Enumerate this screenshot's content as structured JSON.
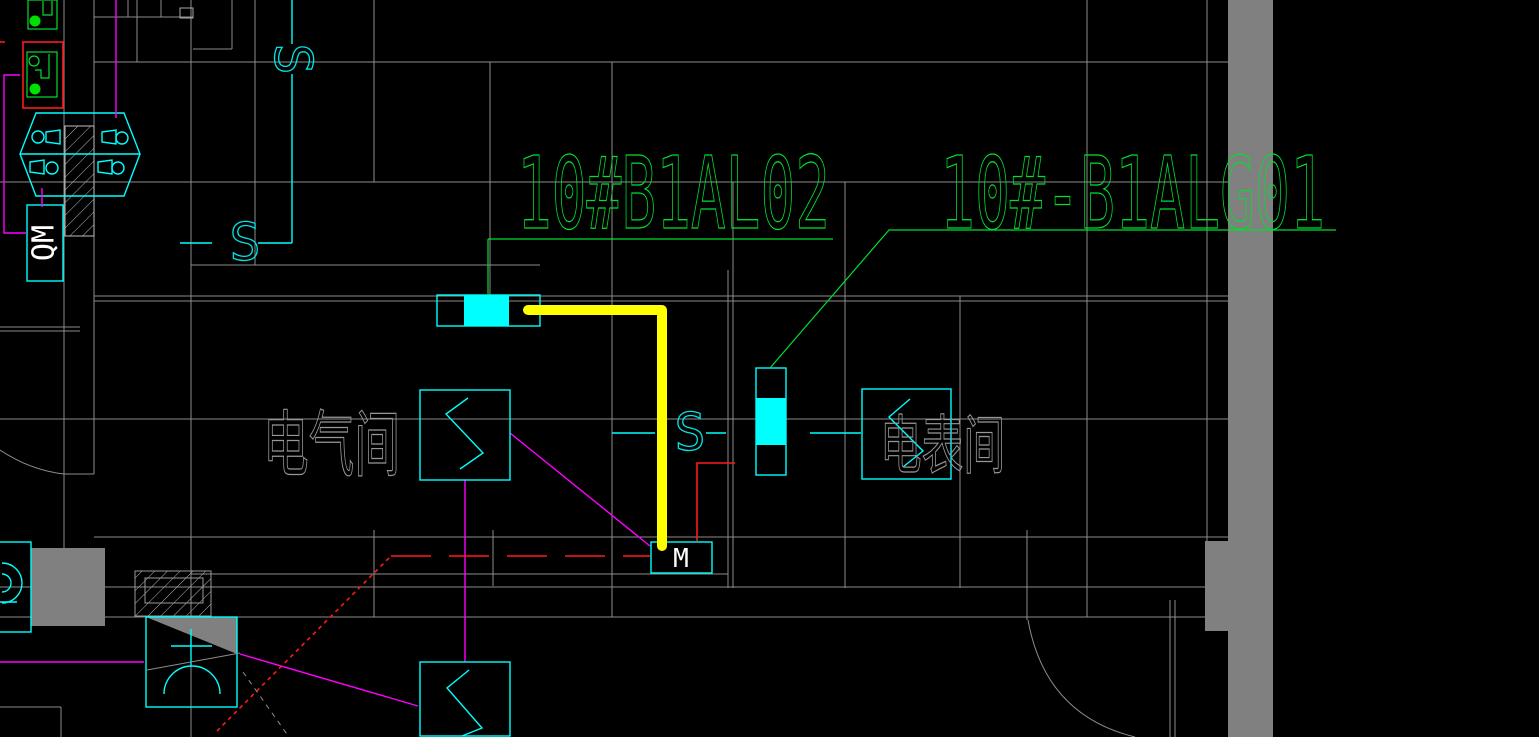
{
  "canvas": {
    "width": 1539,
    "height": 737,
    "background": "#000000"
  },
  "colors": {
    "grid_line": "#8d8d8d",
    "wall_fill": "#808080",
    "device_cyan": "#00ffff",
    "circuit_green": "#00df2e",
    "wire_magenta": "#ff00ff",
    "alert_red": "#ff1a1a",
    "highlight_yellow": "#ffff00",
    "text_white": "#ffffff",
    "text_gray": "#989898"
  },
  "circuit_labels": {
    "label1": "10#B1AL02",
    "label2": "10#-B1ALG01"
  },
  "room_labels": {
    "electrical_room": "电气间",
    "meter_room": "电表间"
  },
  "equipment_labels": {
    "isolator": "QM",
    "meter": "M",
    "switch_top": "S",
    "switch_mid": "S",
    "switch_right": "S"
  }
}
